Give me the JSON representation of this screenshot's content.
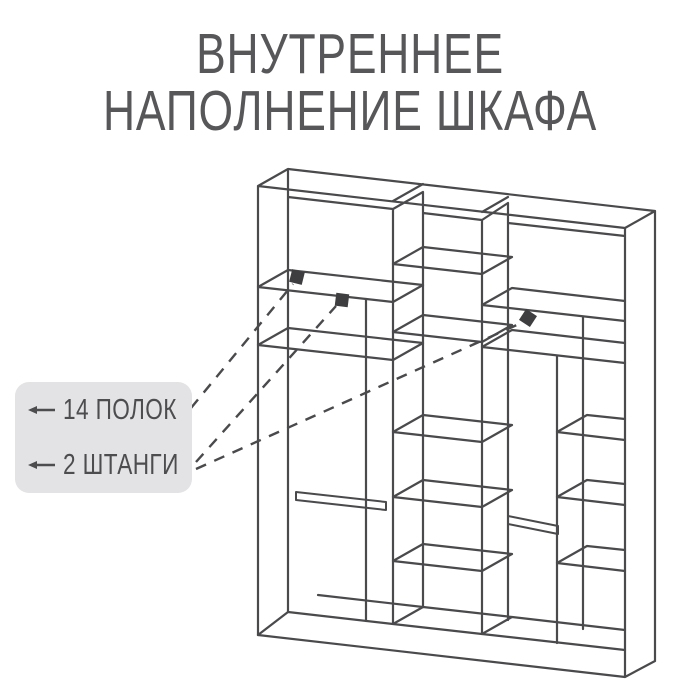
{
  "title": {
    "line1": "ВНУТРЕННЕЕ",
    "line2": "НАПОЛНЕНИЕ ШКАФА"
  },
  "callout": {
    "items": [
      {
        "label": "14 ПОЛОК"
      },
      {
        "label": "2 ШТАНГИ"
      }
    ]
  },
  "diagram": {
    "subject": "wardrobe-interior-line-drawing",
    "sections": 3,
    "shelf_markers": 1,
    "rod_markers": 2
  },
  "colors": {
    "background": "#ffffff",
    "line": "#4a4a4d",
    "title_text": "#57575a",
    "callout_bg": "#e3e3e5",
    "callout_text": "#4d4d50",
    "marker": "#3e3e41"
  }
}
